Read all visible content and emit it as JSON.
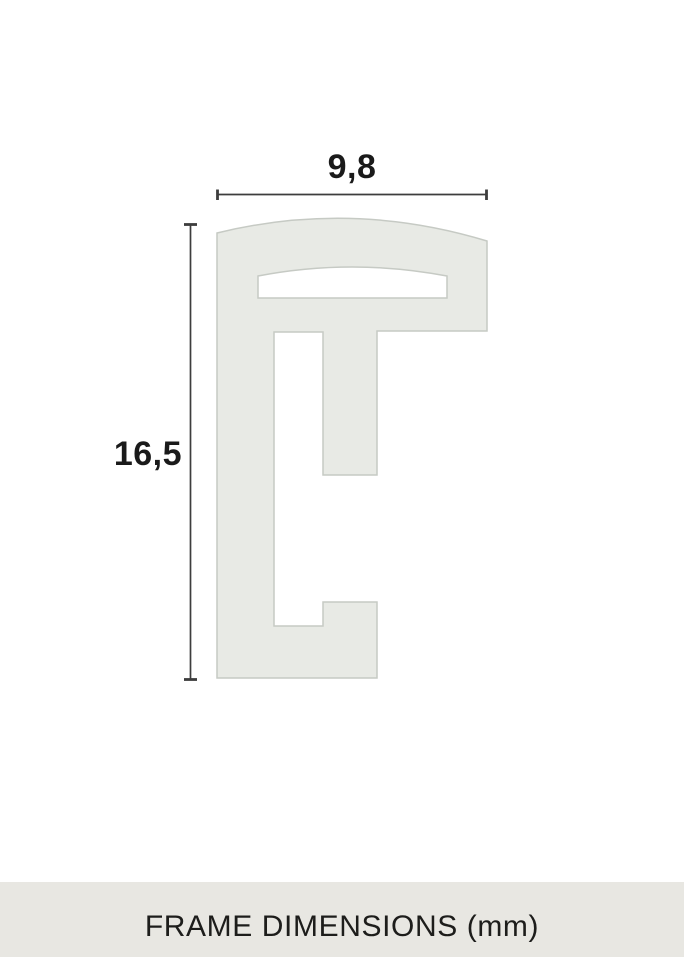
{
  "diagram": {
    "width_label": "9,8",
    "height_label": "16,5",
    "width_mm": 9.8,
    "height_mm": 16.5
  },
  "footer": {
    "title": "FRAME DIMENSIONS (mm)"
  },
  "colors": {
    "background": "#ffffff",
    "profile_fill": "#e8eae5",
    "profile_stroke": "#c6cac4",
    "dimension_line": "#3d3d3d",
    "label_text": "#1a1a1a",
    "footer_bg": "#e8e7e2",
    "footer_text": "#1d1d1b"
  }
}
